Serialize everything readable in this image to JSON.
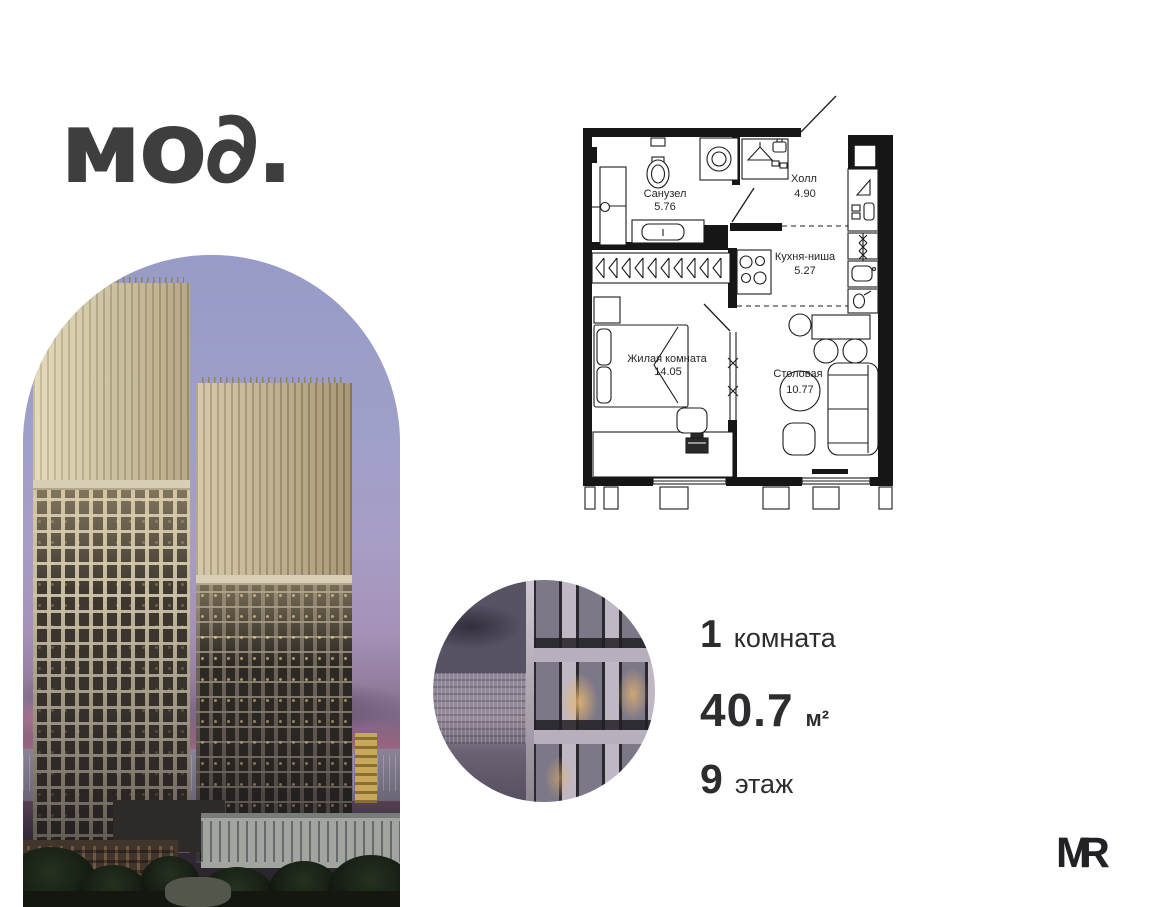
{
  "brand": {
    "logo_text": "мо∂.",
    "mr_m": "M",
    "mr_r": "R"
  },
  "floor_plan": {
    "rooms": [
      {
        "name": "Санузел",
        "area": "5.76"
      },
      {
        "name": "Холл",
        "area": "4.90"
      },
      {
        "name": "Кухня-ниша",
        "area": "5.27"
      },
      {
        "name": "Жилая комната",
        "area": "14.05"
      },
      {
        "name": "Столовая",
        "area": "10.77"
      }
    ]
  },
  "unit_info": {
    "rooms": {
      "value": "1",
      "label": "комната"
    },
    "area": {
      "value": "40.7",
      "unit": "м²"
    },
    "floor": {
      "value": "9",
      "label": "этаж"
    }
  },
  "colors": {
    "text_primary": "#2d2d2f",
    "plan_line": "#1c1c1c",
    "sky_top": "#979bc7",
    "dusk_pink": "#b77d92",
    "crown_gold": "#dacead"
  }
}
